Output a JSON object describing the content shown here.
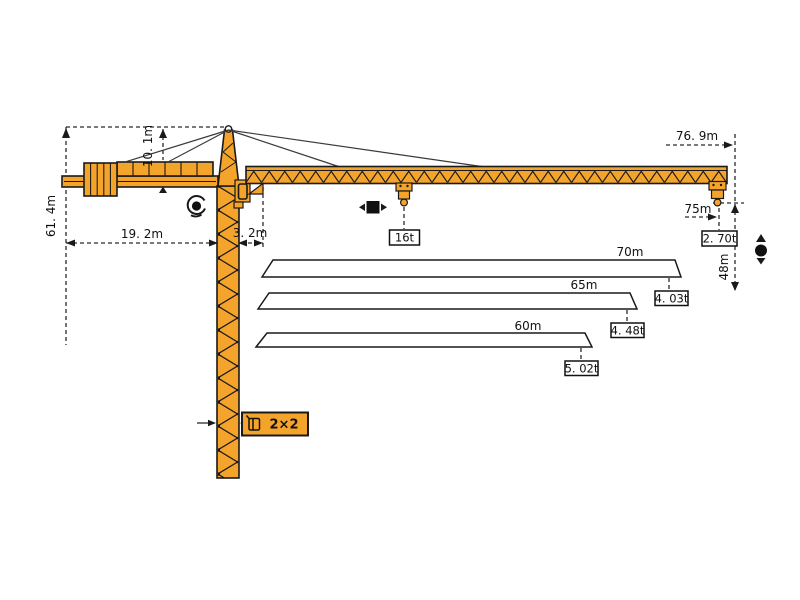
{
  "colors": {
    "crane_orange": "#F5A42B",
    "outline": "#1A1A1A",
    "dash_line": "#2B2B2B",
    "background": "#FFFFFF"
  },
  "dimensions": {
    "total_height": "61. 4m",
    "head_height": "10. 1m",
    "counterjib_radius": "19. 2m",
    "rear_offset": "3. 2m",
    "tip_radius": "76. 9m",
    "max_radius": "75m",
    "tip_capacity": "2. 70t",
    "hook_height": "48m",
    "max_capacity": "16t",
    "mast_section": "2×2"
  },
  "jib_options": [
    {
      "length": "70m",
      "tip_capacity": "4. 03t"
    },
    {
      "length": "65m",
      "tip_capacity": "4. 48t"
    },
    {
      "length": "60m",
      "tip_capacity": "5. 02t"
    }
  ],
  "icons": {
    "slewing": "rotation-icon",
    "trolley": "trolley-travel-icon",
    "hoisting": "hoist-up-down-icon",
    "mast_section": "mast-cross-section-icon"
  }
}
